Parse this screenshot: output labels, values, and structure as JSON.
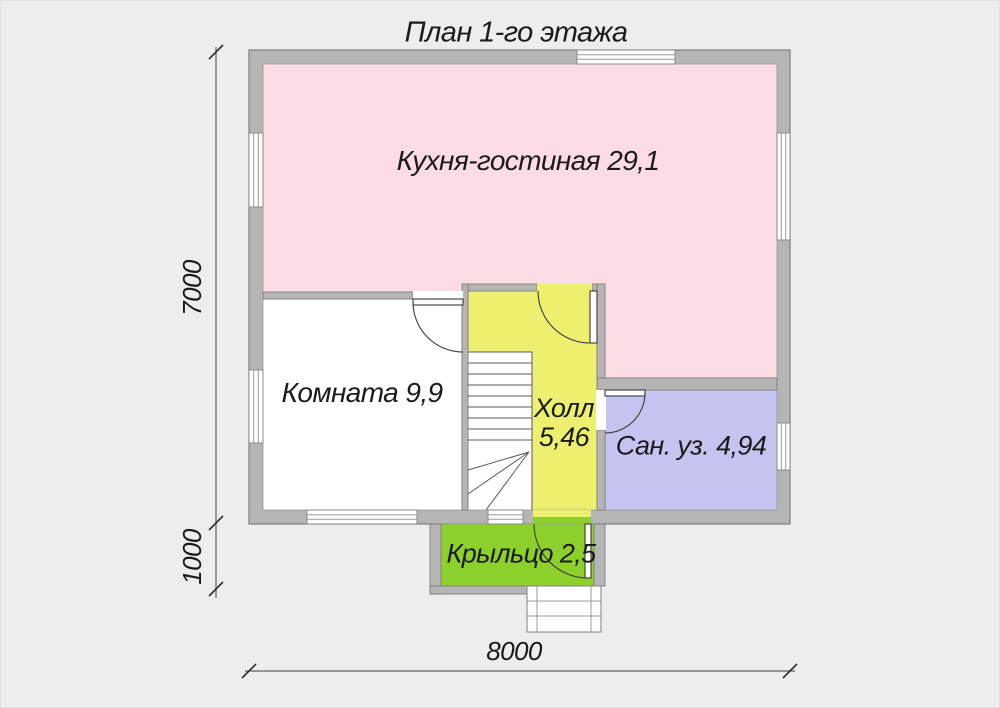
{
  "title": "План 1-го этажа",
  "rooms": {
    "kitchen": {
      "name": "Кухня-гостиная",
      "area": "29,1",
      "color": "#fadce2"
    },
    "room": {
      "name": "Комната",
      "area": "9,9",
      "color": "#ffffff"
    },
    "hall": {
      "name": "Холл",
      "area": "5,46",
      "color": "#edf06f"
    },
    "bathroom": {
      "name": "Сан. уз.",
      "area": "4,94",
      "color": "#c5c4f0"
    },
    "porch": {
      "name": "Крыльцо",
      "area": "2,5",
      "color": "#8ed02b"
    }
  },
  "dimensions": {
    "total_height": "7000",
    "porch_depth": "1000",
    "total_width": "8000"
  },
  "colors": {
    "background": "#ededee",
    "wall": "#b5b5b5",
    "wall_outline": "#7e7e7e",
    "line": "#3a3a3a",
    "text": "#1b1b1b"
  }
}
